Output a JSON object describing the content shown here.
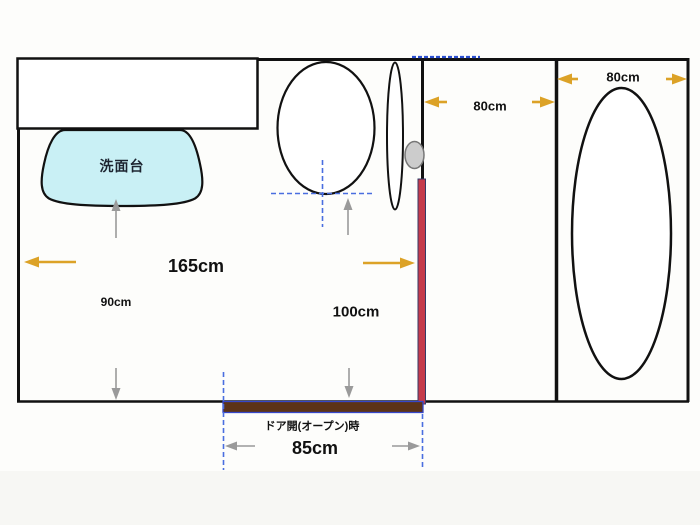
{
  "plan": {
    "washbasin_label": "洗面台",
    "door_open_label": "ドア開(オープン)時",
    "dim_room_width": "165cm",
    "dim_basin_clearance": "90cm",
    "dim_door_clearance": "100cm",
    "dim_corridor_width": "80cm",
    "dim_bathroom_width": "80cm",
    "dim_door_open_width": "85cm"
  },
  "colors": {
    "wall": "#111111",
    "washbasin_fill": "#c9f0f5",
    "door_closed_bar": "#c43a4b",
    "door_open_panel": "#5c3317",
    "door_open_border": "#3647c9",
    "dimension_arrow_orange": "#dca227",
    "clearance_arrow_gray": "#9a9a9a",
    "guide_dash_blue": "#4a6ee0",
    "doorknob_fill": "#cccccc"
  }
}
